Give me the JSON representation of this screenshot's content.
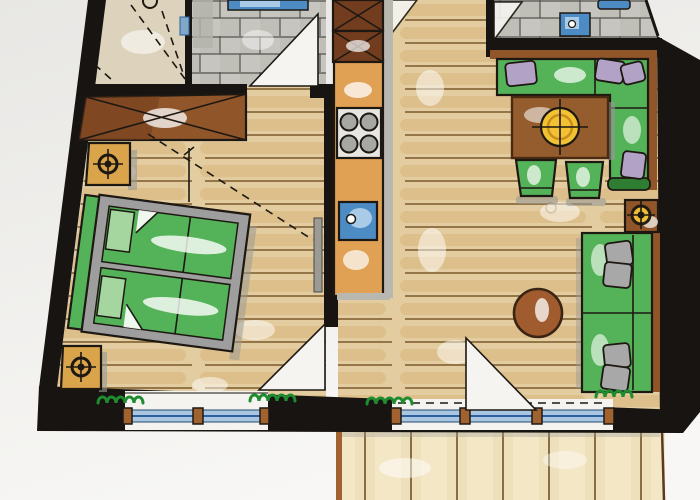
{
  "title": "hand-drawn-apartment-floor-plan",
  "colors": {
    "wall": "#181411",
    "ink": "#1d1812",
    "floor": "#e3cda0",
    "plankLine": "#7a5a2a",
    "plankStreak": "#cda15e",
    "hallFloor": "#ddd2bc",
    "tile": "#c6c5bf",
    "tileLine": "#55534e",
    "tileShade": "#b4b3ab",
    "green": "#54b258",
    "greenDark": "#2e7d32",
    "greenLight": "#a5d6a0",
    "frameGray": "#9e9e9e",
    "pillowPurple": "#b2a2c6",
    "pillowGray": "#a8a8a8",
    "cabinetDark": "#723d1e",
    "counter": "#e0a155",
    "woodBrown": "#91552a",
    "tableBrown": "#955d2e",
    "nightstand": "#d9a44a",
    "sink": "#4d8bc4",
    "sinkLight": "#a9cbe8",
    "glass": "#a9c6e0",
    "glassLine": "#2f5f9e",
    "post": "#a0622e",
    "lampYellow": "#f2c233",
    "pouf": "#a05c2f",
    "terrace": "#eee0ba",
    "terraceLine": "#6d5126",
    "plantGreen": "#1f8c2f",
    "shadow": "#9a9a94",
    "bgTop": "#e8e7e4",
    "bgBottom": "#f8f7f5",
    "outside": "#f4f3ef"
  },
  "icons": {
    "ceiling_lamp": "target-crosshair-icon",
    "stove_burner": "burner-circle-icon",
    "faucet": "faucet-dot-icon",
    "plant": "squiggle-plant-icon"
  },
  "legend": {
    "drawing_type": "marker-rendered floor plan, no text labels visible"
  }
}
